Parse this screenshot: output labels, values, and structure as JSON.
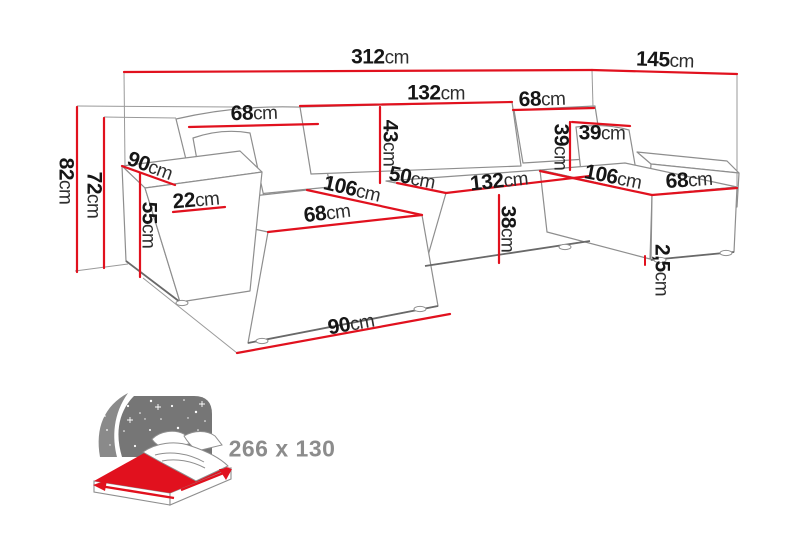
{
  "diagram_title": "corner-sofa-dimension-diagram",
  "dims": {
    "total_width": {
      "num": "312",
      "unit": "cm"
    },
    "total_depth": {
      "num": "145",
      "unit": "cm"
    },
    "backrest_mid_width": {
      "num": "132",
      "unit": "cm"
    },
    "backrest_left_width": {
      "num": "68",
      "unit": "cm"
    },
    "backrest_right_width": {
      "num": "68",
      "unit": "cm"
    },
    "backrest_height": {
      "num": "43",
      "unit": "cm"
    },
    "right_cushion_height": {
      "num": "39",
      "unit": "cm"
    },
    "right_cushion_width": {
      "num": "39",
      "unit": "cm"
    },
    "total_height": {
      "num": "82",
      "unit": "cm"
    },
    "backrest_total_height": {
      "num": "72",
      "unit": "cm"
    },
    "left_chaise_depth": {
      "num": "90",
      "unit": "cm"
    },
    "armrest_height": {
      "num": "55",
      "unit": "cm"
    },
    "armrest_width": {
      "num": "22",
      "unit": "cm"
    },
    "left_seat_length": {
      "num": "106",
      "unit": "cm"
    },
    "left_seat_width": {
      "num": "68",
      "unit": "cm"
    },
    "mid_seat_depth": {
      "num": "50",
      "unit": "cm"
    },
    "mid_seat_width": {
      "num": "132",
      "unit": "cm"
    },
    "seat_height": {
      "num": "38",
      "unit": "cm"
    },
    "right_seat_length": {
      "num": "106",
      "unit": "cm"
    },
    "right_seat_width": {
      "num": "68",
      "unit": "cm"
    },
    "leg_height": {
      "num": "2,5",
      "unit": "cm"
    },
    "left_chaise_front_width": {
      "num": "90",
      "unit": "cm"
    }
  },
  "bed": {
    "size_label": "266 x 130"
  },
  "colors": {
    "dimension_line": "#e1111e",
    "sofa_outline": "#8e8e8e",
    "label_number": "#161616",
    "label_unit": "#2e2e2e",
    "bed_mattress_red": "#e1111e",
    "bed_headboard_gray": "#7a7a7a",
    "bed_size_text": "#8c8c8c"
  }
}
